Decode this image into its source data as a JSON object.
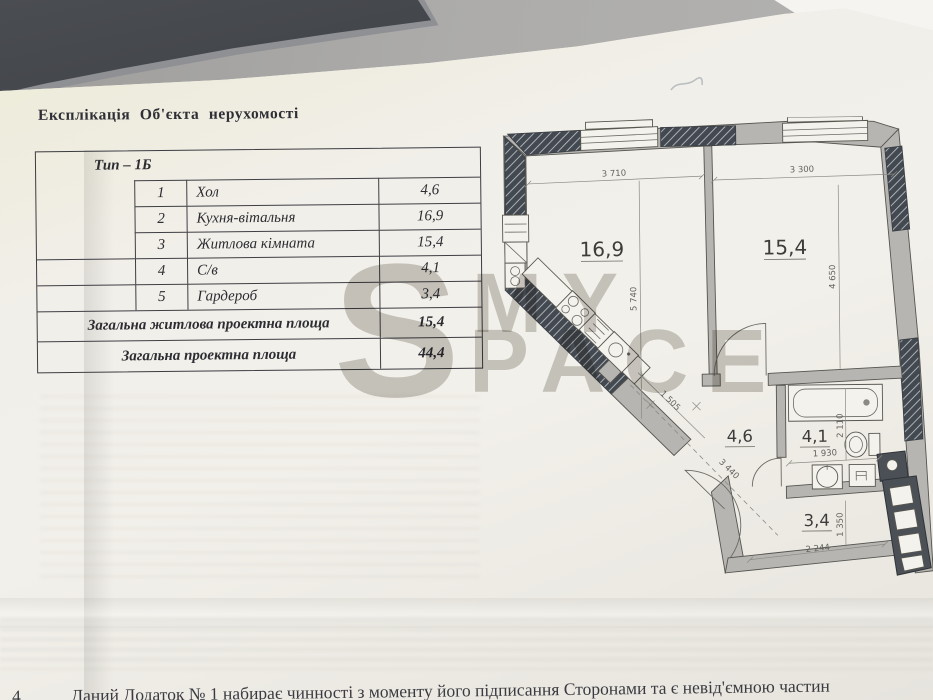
{
  "doc": {
    "title": "Експлікація Об'єкта нерухомості",
    "table": {
      "type_header": "Тип – 1Б",
      "rows": [
        {
          "num": "1",
          "name": "Хол",
          "area": "4,6"
        },
        {
          "num": "2",
          "name": "Кухня-вітальня",
          "area": "16,9"
        },
        {
          "num": "3",
          "name": "Житлова кімната",
          "area": "15,4"
        },
        {
          "num": "4",
          "name": "С/в",
          "area": "4,1"
        },
        {
          "num": "5",
          "name": "Гардероб",
          "area": "3,4"
        }
      ],
      "totals": [
        {
          "label": "Загальна житлова проектна площа",
          "value": "15,4"
        },
        {
          "label": "Загальна проектна площа",
          "value": "44,4"
        }
      ]
    },
    "footer": {
      "number": "4.",
      "text": "Даний Додаток № 1 набирає чинності з моменту його підписання Сторонами та є невід'ємною частин"
    }
  },
  "watermark": {
    "s": "S",
    "my": "MY",
    "pace": "PACE"
  },
  "plan": {
    "areas": {
      "kitchen": "16,9",
      "room": "15,4",
      "hall": "4,6",
      "bath": "4,1",
      "wardrobe": "3,4"
    },
    "dims": {
      "kitchen_w": "3 710",
      "room_w": "3 300",
      "kitchen_h": "5 740",
      "room_h": "4 650",
      "hall_w": "1 505",
      "hall_l": "3 440",
      "bath_w": "1 930",
      "bath_h": "2 110",
      "ward_w": "2 244",
      "ward_h": "1 350"
    }
  },
  "colors": {
    "paper": "#f0eee8",
    "desk": "#a9a8a5",
    "phone": "#34373b",
    "ink": "#2e2e34",
    "wall": "#b7b5b1",
    "hatch": "#434950",
    "watermark": "#cfcdc9"
  }
}
